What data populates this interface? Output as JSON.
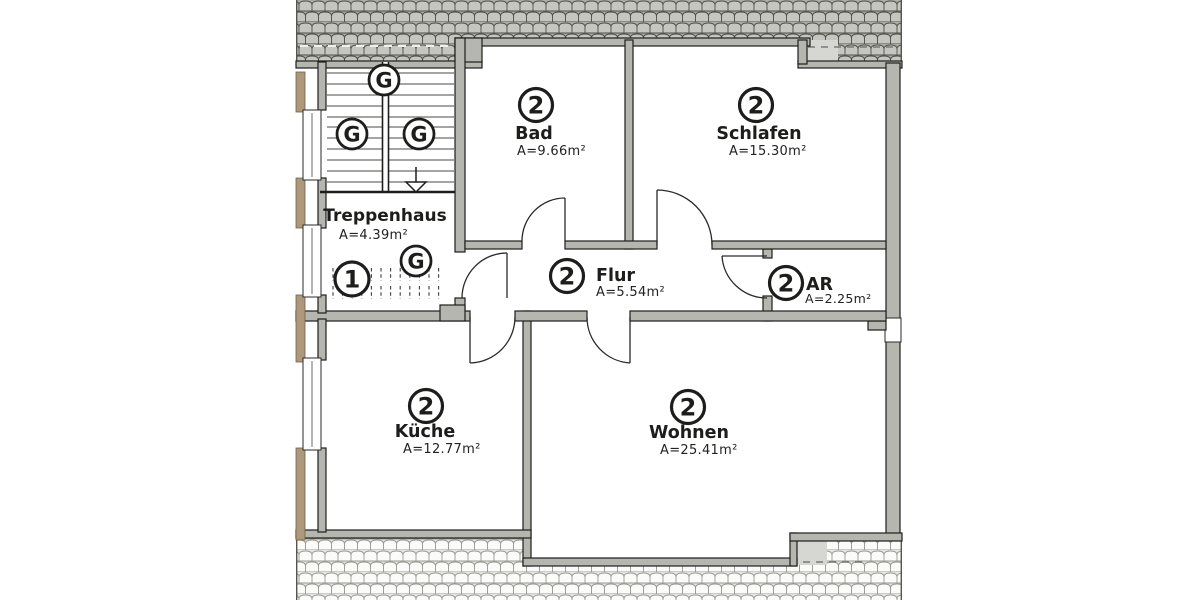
{
  "rooms": {
    "bad": {
      "unit": "2",
      "name": "Bad",
      "area": "A=9.66m²"
    },
    "schlafen": {
      "unit": "2",
      "name": "Schlafen",
      "area": "A=15.30m²"
    },
    "treppenhaus": {
      "name": "Treppenhaus",
      "area": "A=4.39m²"
    },
    "flur": {
      "unit": "2",
      "name": "Flur",
      "area": "A=5.54m²"
    },
    "ar": {
      "unit": "2",
      "name": "AR",
      "area": "A=2.25m²"
    },
    "kueche": {
      "unit": "2",
      "name": "Küche",
      "area": "A=12.77m²"
    },
    "wohnen": {
      "unit": "2",
      "name": "Wohnen",
      "area": "A=25.41m²"
    }
  },
  "markers": {
    "g": "G",
    "one": "1"
  },
  "colors": {
    "wall": "#b6b6b1",
    "ink": "#1d1d1b",
    "tan": "#ad987b",
    "tilebg": "#adada8",
    "tilefill": "#c6c6c1",
    "tileline": "#50504a",
    "tilebg2": "#e6e6e2",
    "tilefill2": "#fbfbfa",
    "tileline2": "#9a9a93"
  }
}
